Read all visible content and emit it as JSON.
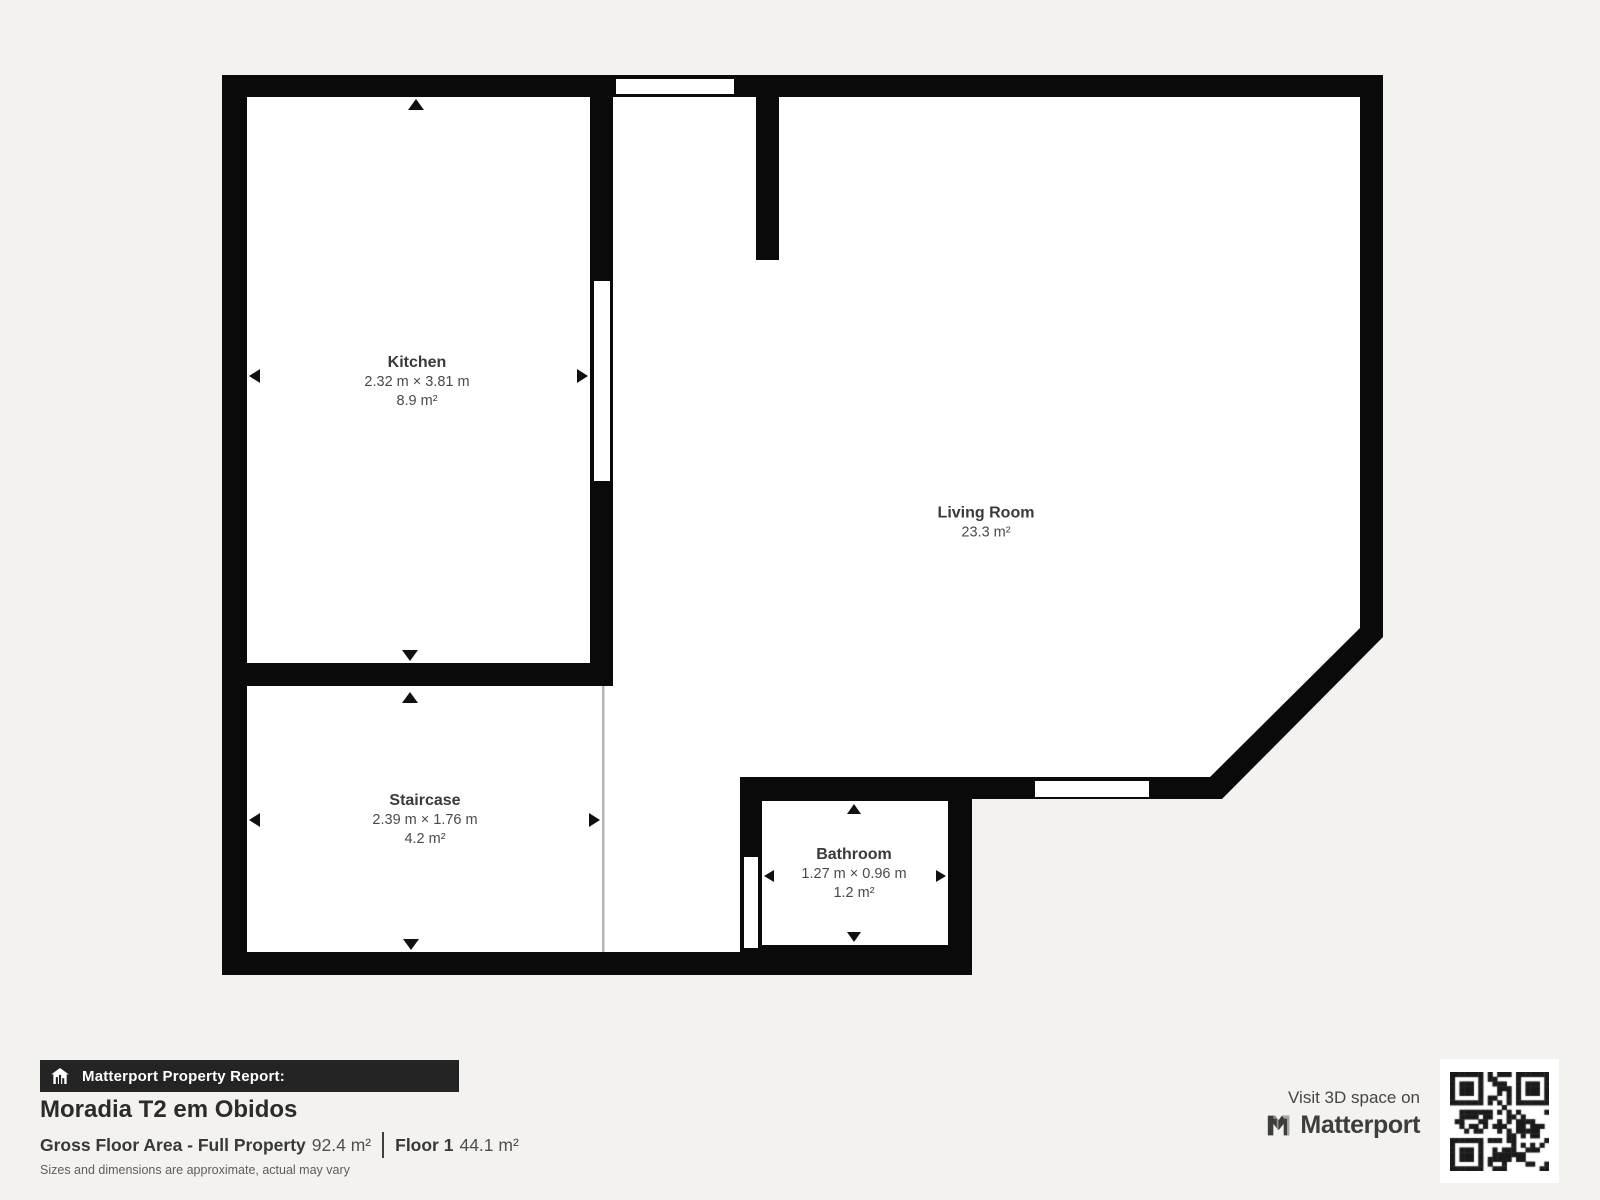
{
  "floor_plan": {
    "rooms": [
      {
        "name": "Kitchen",
        "dimensions": "2.32 m × 3.81 m",
        "area": "8.9 m²"
      },
      {
        "name": "Living Room",
        "dimensions": "",
        "area": "23.3 m²"
      },
      {
        "name": "Staircase",
        "dimensions": "2.39 m × 1.76 m",
        "area": "4.2 m²"
      },
      {
        "name": "Bathroom",
        "dimensions": "1.27 m × 0.96 m",
        "area": "1.2 m²"
      }
    ]
  },
  "report": {
    "bar_label": "Matterport Property Report:",
    "property_title": "Moradia T2 em Obidos",
    "gross_floor_area_label": "Gross Floor Area - Full Property",
    "gross_floor_area_value": "92.4 m²",
    "floor_label": "Floor 1",
    "floor_value": "44.1 m²",
    "disclaimer": "Sizes and dimensions are approximate, actual may vary"
  },
  "promo": {
    "visit_text": "Visit 3D space on",
    "brand": "Matterport"
  },
  "icons": [
    "home-icon",
    "matterport-logo-icon",
    "qr-code"
  ],
  "colors": {
    "background": "#f3f2ef",
    "walls": "#0a0a0a",
    "floor": "#ffffff",
    "report_bar": "#242424",
    "text_dark": "#2b2b2b",
    "text_room": "#3e3e3e"
  }
}
